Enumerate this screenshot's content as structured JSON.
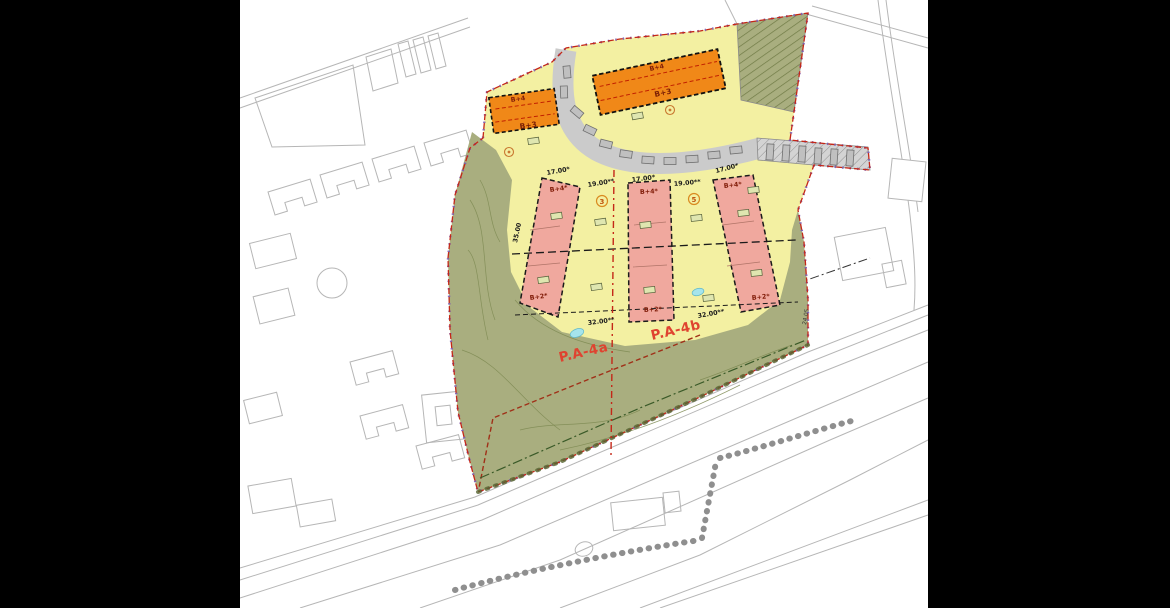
{
  "plan": {
    "zone_labels": {
      "a": "P.A-4a",
      "b": "P.A-4b"
    },
    "buildings": {
      "left": {
        "upper": "B+4",
        "lower": "B+3"
      },
      "right": {
        "upper": "B+4",
        "lower": "B+3"
      }
    },
    "plots": [
      {
        "upper": "B+4*",
        "lower": "B+2*"
      },
      {
        "upper": "B+4*",
        "lower": "B+2*"
      },
      {
        "upper": "B+4*",
        "lower": "B+2*"
      }
    ],
    "markers": {
      "circle_1": "3",
      "circle_2": "5"
    },
    "dimensions": {
      "top": [
        "17.00*",
        "19.00**",
        "17.00*",
        "19.00**",
        "17.00*"
      ],
      "bottom": [
        "32.00**",
        "32.00**"
      ],
      "left_side": "35.00",
      "right_side": "24.05"
    },
    "colors": {
      "letterbox": "#000000",
      "background": "#ffffff",
      "zone_yellow": "#f3f0a2",
      "zone_olive": "#a9ae7f",
      "plot_pink": "#f0a89e",
      "building_orange": "#f08818",
      "road_gray": "#cbcbcb",
      "boundary_red": "#c42718",
      "boundary_purple": "#7a58b0",
      "zone_label_red": "#df4330",
      "pond_cyan": "#a5e4ec",
      "basemap_gray": "#b6b6b6"
    }
  }
}
